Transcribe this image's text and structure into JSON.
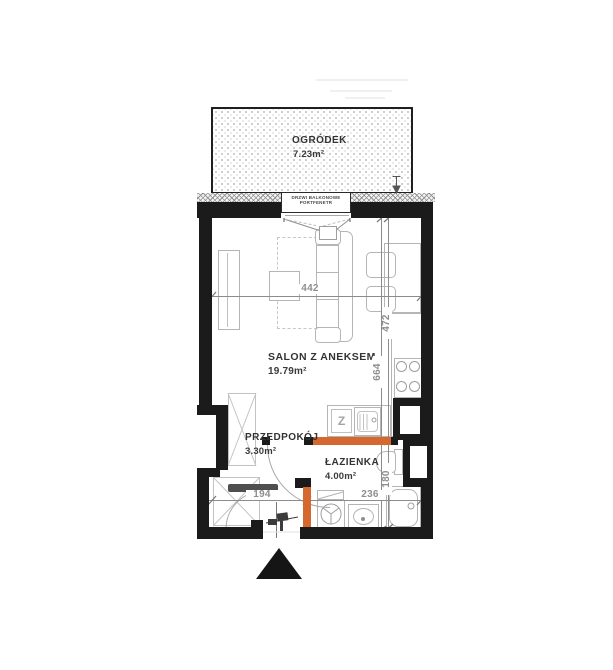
{
  "plan": {
    "rooms": {
      "garden": {
        "name": "OGRÓDEK",
        "area": "7.23m²"
      },
      "salon": {
        "name": "SALON Z ANEKSEM",
        "area": "19.79m²"
      },
      "hall": {
        "name": "PRZEDPOKÓJ",
        "area": "3.30m²"
      },
      "bath": {
        "name": "ŁAZIENKA",
        "area": "4.00m²"
      }
    },
    "dimensions": {
      "salon_width": "442",
      "salon_length": "472",
      "total_length": "664",
      "hall_width": "194",
      "bath_width": "236",
      "bath_length": "180"
    },
    "balcony_door_note": {
      "line1": "DRZWI BALKONOWE",
      "line2": "PORTFENETR"
    },
    "appliance_labels": {
      "dishwasher": "Z"
    },
    "colors": {
      "wall": "#1b1b1b",
      "accent_wall": "#d4682f",
      "furniture_line": "#b5b5b5",
      "dimension_text": "#8e8e8e",
      "label_text": "#333333"
    }
  }
}
